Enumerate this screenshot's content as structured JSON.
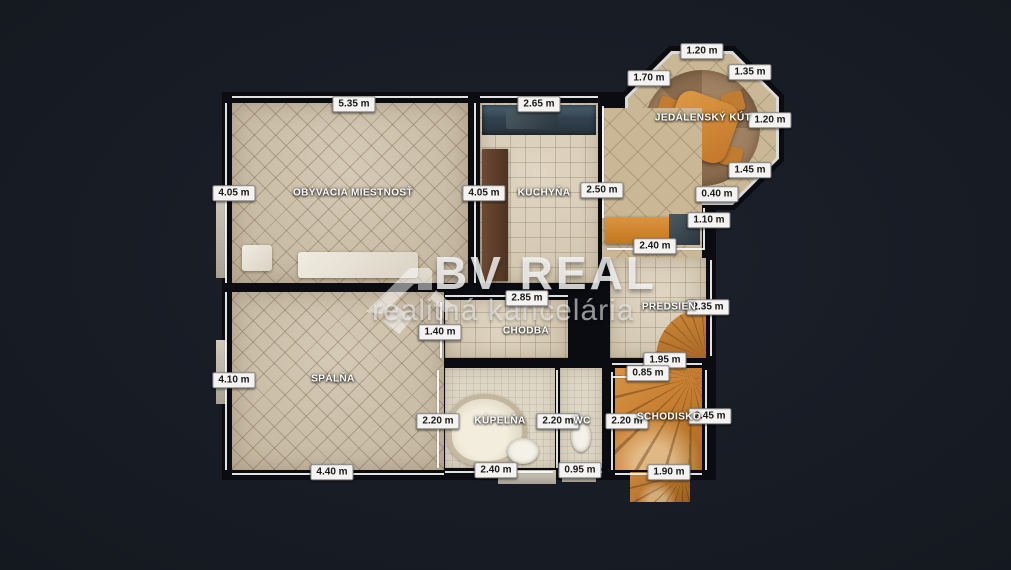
{
  "watermark": {
    "line1": "BV REAL",
    "line2": "realitná kancelária"
  },
  "colors": {
    "page_background": "#181c25",
    "wall": "#0a0c11",
    "floor_beige": "#cbbfa9",
    "wood_orange": "#c47c2f",
    "label_background": "#f4f3f1",
    "label_text": "#17181a",
    "watermark_white": "#f8f8f8"
  },
  "rooms": [
    {
      "id": "living",
      "label": "OBÝVACIA MIESTNOSŤ",
      "x": 353,
      "y": 193
    },
    {
      "id": "kitchen",
      "label": "KUCHYŇA",
      "x": 544,
      "y": 193
    },
    {
      "id": "dining",
      "label": "JEDÁLENSKÝ KÚT",
      "x": 703,
      "y": 118
    },
    {
      "id": "hallway",
      "label": "PREDSIEŇ",
      "x": 669,
      "y": 307
    },
    {
      "id": "corridor",
      "label": "CHODBA",
      "x": 526,
      "y": 331
    },
    {
      "id": "bedroom",
      "label": "SPÁLŇA",
      "x": 333,
      "y": 379
    },
    {
      "id": "bathroom",
      "label": "KÚPEĽŇA",
      "x": 500,
      "y": 421
    },
    {
      "id": "wc",
      "label": "WC",
      "x": 582,
      "y": 421
    },
    {
      "id": "stairs",
      "label": "SCHODISKO",
      "x": 669,
      "y": 417
    }
  ],
  "dimensions": [
    {
      "text": "5.35 m",
      "x": 354,
      "y": 104
    },
    {
      "text": "2.65 m",
      "x": 539,
      "y": 104
    },
    {
      "text": "4.05 m",
      "x": 234,
      "y": 193
    },
    {
      "text": "4.05 m",
      "x": 484,
      "y": 193
    },
    {
      "text": "2.50 m",
      "x": 602,
      "y": 190
    },
    {
      "text": "1.20 m",
      "x": 702,
      "y": 51
    },
    {
      "text": "1.70 m",
      "x": 649,
      "y": 78
    },
    {
      "text": "1.35 m",
      "x": 750,
      "y": 72
    },
    {
      "text": "1.20 m",
      "x": 770,
      "y": 120
    },
    {
      "text": "1.45 m",
      "x": 750,
      "y": 170
    },
    {
      "text": "0.40 m",
      "x": 717,
      "y": 194
    },
    {
      "text": "1.10 m",
      "x": 709,
      "y": 220
    },
    {
      "text": "2.40 m",
      "x": 655,
      "y": 246
    },
    {
      "text": "2.85 m",
      "x": 527,
      "y": 298
    },
    {
      "text": "2.35 m",
      "x": 708,
      "y": 307
    },
    {
      "text": "1.40 m",
      "x": 440,
      "y": 332
    },
    {
      "text": "1.95 m",
      "x": 665,
      "y": 360
    },
    {
      "text": "0.85 m",
      "x": 648,
      "y": 373
    },
    {
      "text": "4.10 m",
      "x": 234,
      "y": 380
    },
    {
      "text": "4.40 m",
      "x": 332,
      "y": 472
    },
    {
      "text": "2.20 m",
      "x": 438,
      "y": 421
    },
    {
      "text": "2.40 m",
      "x": 496,
      "y": 470
    },
    {
      "text": "2.20 m",
      "x": 558,
      "y": 421
    },
    {
      "text": "0.95 m",
      "x": 580,
      "y": 470
    },
    {
      "text": "2.20 m",
      "x": 627,
      "y": 421
    },
    {
      "text": "2.45 m",
      "x": 710,
      "y": 416
    },
    {
      "text": "1.90 m",
      "x": 669,
      "y": 472
    }
  ]
}
